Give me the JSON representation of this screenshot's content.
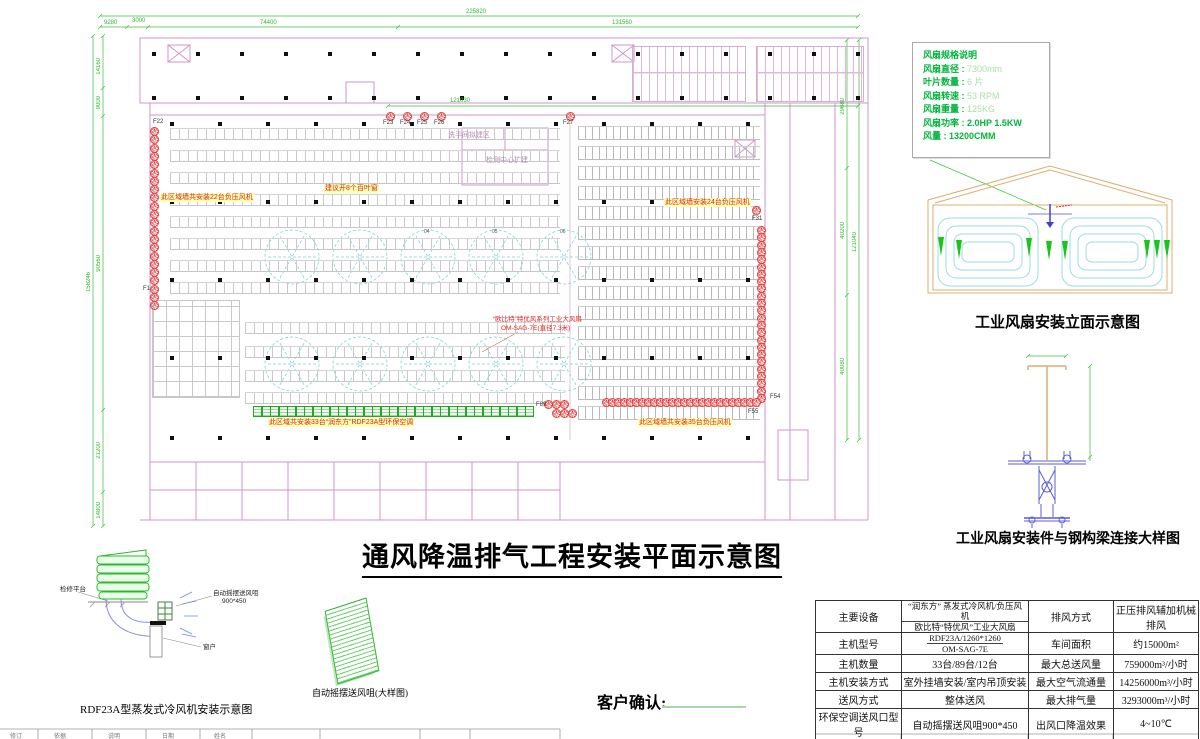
{
  "titles": {
    "main": "通风降温排气工程安装平面示意图",
    "elevation": "工业风扇安装立面示意图",
    "beam_detail": "工业风扇安装件与钢构梁连接大样图",
    "cooler_detail": "RDF23A型蒸发式冷风机安装示意图",
    "nozzle_detail": "自动摇摆送风咀(大样图)",
    "customer_confirm": "客户确认:"
  },
  "fan_spec": {
    "title": "风扇规格说明",
    "items": [
      {
        "label": "风扇直径",
        "value": "7300mm",
        "pale": true
      },
      {
        "label": "叶片数量",
        "value": "6 片",
        "pale": true
      },
      {
        "label": "风扇转速",
        "value": "53 RPM",
        "pale": true
      },
      {
        "label": "风扇重量",
        "value": "125KG",
        "pale": true
      },
      {
        "label": "风扇功率",
        "value": "2.0HP 1.5KW",
        "pale": false
      },
      {
        "label": "风量",
        "value": "13200CMM",
        "pale": false
      }
    ]
  },
  "plan": {
    "annotations": {
      "left_fans": "此区域墙共安装22台负压风机",
      "louver_suggest": "建议开8个百叶窗",
      "right_fans": "此区域墙安装24台负压风机",
      "coolers": "此区域共安装33台“润东方”RDF23A型环保空调",
      "bottom_right_fans": "此区域墙共安装35台负压风机",
      "big_fan_line1": "“欧比特”特优风系列工业大风扇",
      "big_fan_line2": "OM-SAG-7E(直径7.3米)",
      "washroom": "洗手间拟建区",
      "test_center": "检测中心扩建"
    },
    "markers": [
      "F22",
      "F23",
      "F24",
      "F25",
      "F26",
      "F27",
      "F31",
      "F1",
      "F89",
      "F54",
      "F55"
    ],
    "fan_numbers": [
      "04",
      "05",
      "06"
    ]
  },
  "dimensions": {
    "top": [
      "225820",
      "9280",
      "3000",
      "74400",
      "131560",
      "121030"
    ],
    "left": [
      "14160",
      "9000",
      "90560",
      "21200",
      "14800",
      "158246"
    ],
    "right": [
      "29680",
      "40200",
      "40080",
      "121040"
    ]
  },
  "cooler_detail_labels": {
    "platform": "检修平台",
    "nozzle": "自动摇摆送风咀",
    "nozzle_size": "900*450",
    "window": "窗户"
  },
  "spec_table": {
    "rows": [
      {
        "k1": "主要设备",
        "v1a": "“润东方” 蒸发式冷风机/负压风机",
        "v1b": "欧比特“特优风”工业大风扇",
        "k2": "排风方式",
        "v2": "正压排风辅加机械排风"
      },
      {
        "k1": "主机型号",
        "v1a": "RDF23A/1260*1260",
        "v1b": "OM-SAG-7E",
        "k2": "车间面积",
        "v2": "约15000m²"
      },
      {
        "k1": "主机数量",
        "v1": "33台/89台/12台",
        "k2": "最大总送风量",
        "v2": "759000m³/小时"
      },
      {
        "k1": "主机安装方式",
        "v1": "室外挂墙安装/室内吊顶安装",
        "k2": "最大空气流通量",
        "v2": "14256000m³/小时"
      },
      {
        "k1": "送风方式",
        "v1": "整体送风",
        "k2": "最大排气量",
        "v2": "3293000m³/小时"
      },
      {
        "k1": "环保空调送风口型号",
        "v1": "自动摇摆送风咀900*450",
        "k2": "出风口降温效果",
        "v2": "4~10℃"
      },
      {
        "k1": "环保空调出风口数量",
        "v1": "33个",
        "k2": "风管材料",
        "v2": "镀 锌 钢 板"
      }
    ]
  },
  "titleblock_strip": [
    "修订",
    "依据",
    "说明",
    "日期",
    "姓名"
  ]
}
